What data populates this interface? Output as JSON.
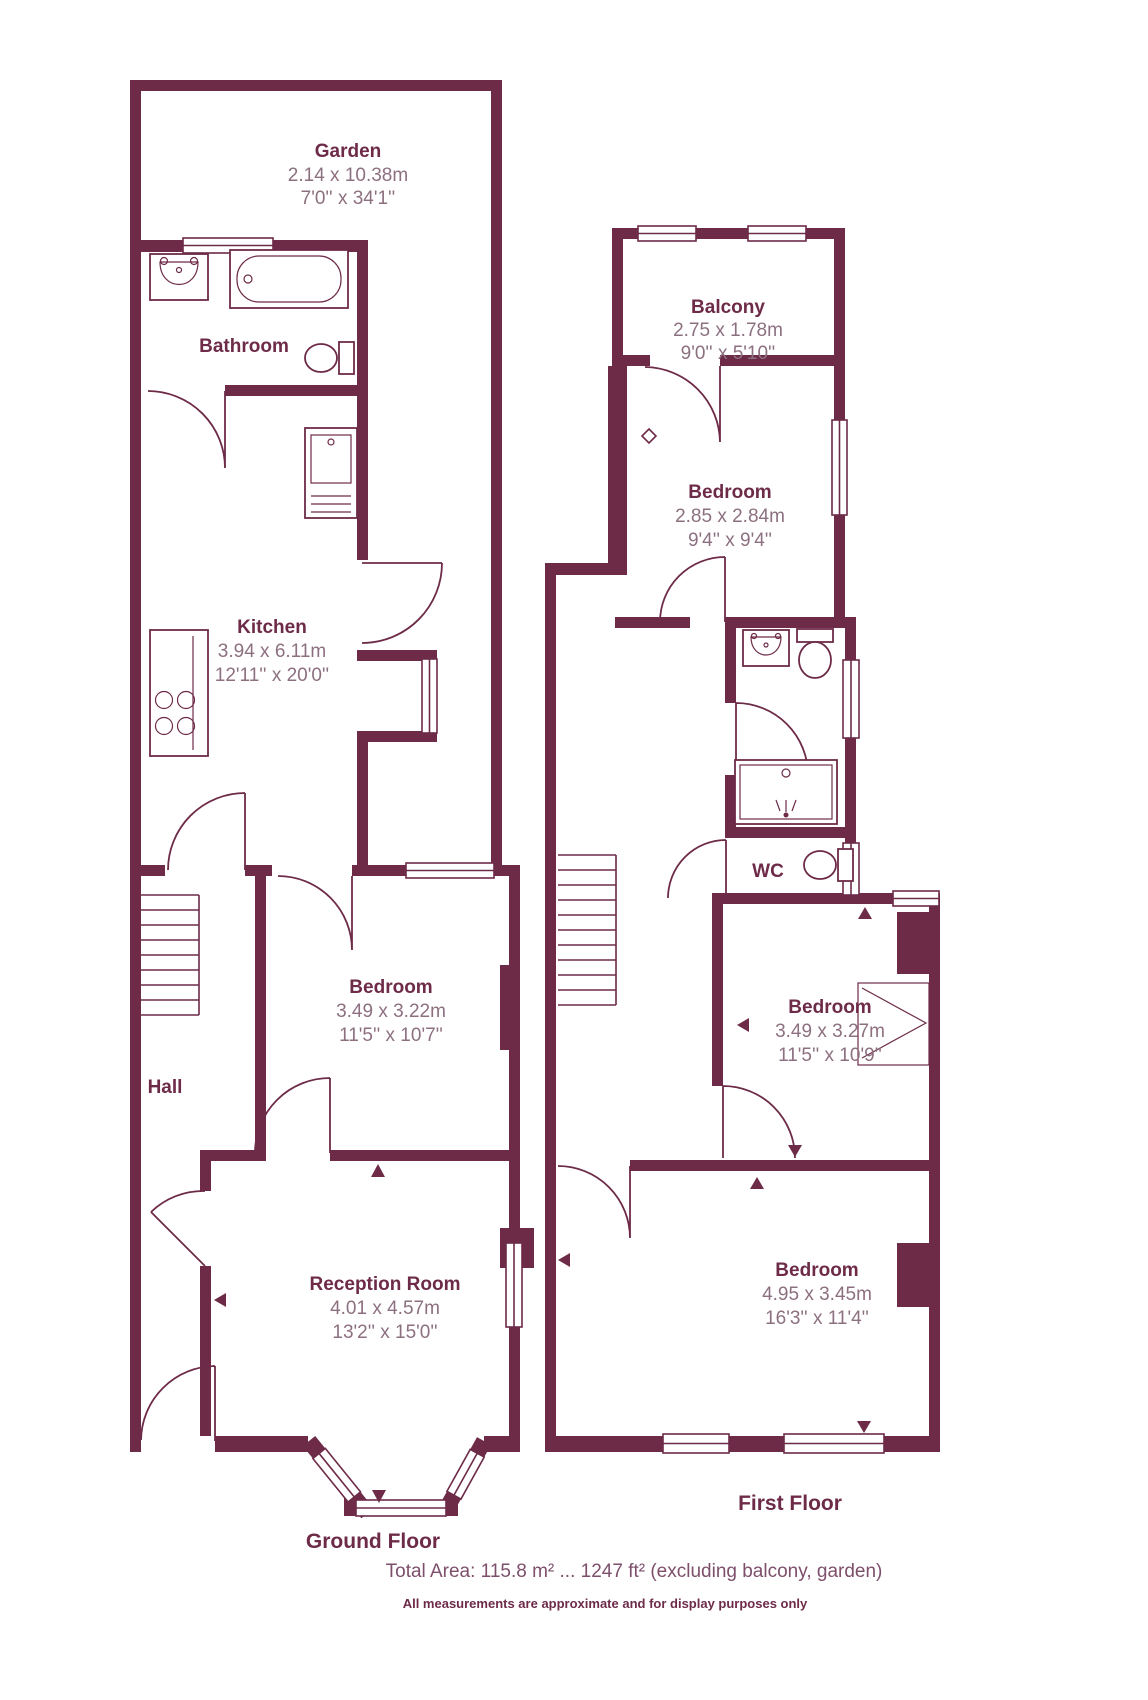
{
  "ground_floor": {
    "title": "Ground Floor",
    "garden": {
      "name": "Garden",
      "metric": "2.14 x 10.38m",
      "imperial": "7'0'' x 34'1''"
    },
    "bathroom": {
      "name": "Bathroom"
    },
    "kitchen": {
      "name": "Kitchen",
      "metric": "3.94 x 6.11m",
      "imperial": "12'11'' x 20'0''"
    },
    "bedroom": {
      "name": "Bedroom",
      "metric": "3.49 x 3.22m",
      "imperial": "11'5'' x 10'7''"
    },
    "hall": {
      "name": "Hall"
    },
    "reception": {
      "name": "Reception Room",
      "metric": "4.01 x 4.57m",
      "imperial": "13'2'' x 15'0''"
    }
  },
  "first_floor": {
    "title": "First Floor",
    "balcony": {
      "name": "Balcony",
      "metric": "2.75 x 1.78m",
      "imperial": "9'0'' x 5'10''"
    },
    "bedroom_rear": {
      "name": "Bedroom",
      "metric": "2.85 x 2.84m",
      "imperial": "9'4'' x 9'4''"
    },
    "wc": {
      "name": "WC"
    },
    "bedroom_middle": {
      "name": "Bedroom",
      "metric": "3.49 x 3.27m",
      "imperial": "11'5'' x 10'9''"
    },
    "bedroom_front": {
      "name": "Bedroom",
      "metric": "4.95 x 3.45m",
      "imperial": "16'3'' x 11'4''"
    }
  },
  "footer": {
    "total_area": "Total Area: 115.8 m²  ...  1247 ft²  (excluding balcony, garden)",
    "disclaimer": "All measurements are approximate and for display purposes only"
  },
  "colors": {
    "wall": "#6d2b48",
    "dimensions": "#8d7080",
    "footer_text": "#7d4f6b"
  }
}
